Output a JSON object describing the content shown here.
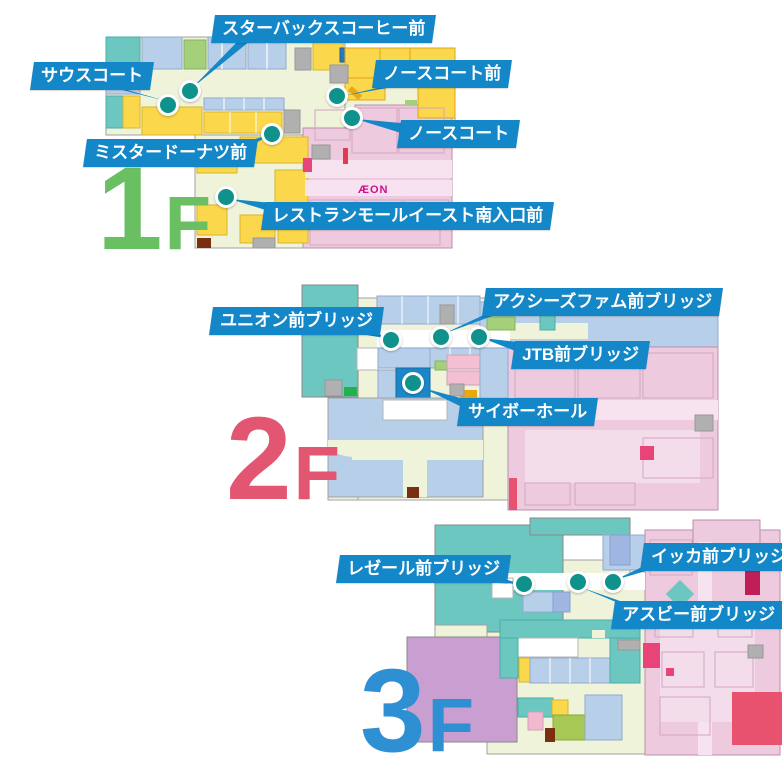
{
  "palette": {
    "callout_blue": "#1387c8",
    "marker_teal": "#0f918c",
    "floor1_green": "#6abf62",
    "floor2_pink": "#e25672",
    "floor3_blue": "#2e8fd3",
    "aeon_magenta": "#cc0e8f",
    "map_teal": "#6cc7c0",
    "map_lightblue": "#b7cfe8",
    "map_yellow": "#fad74b",
    "map_pink": "#eecade",
    "map_cream": "#eef3da"
  },
  "floors": [
    {
      "name": "1F",
      "number": "1",
      "suffix": "F",
      "aeon_logo": "ÆON",
      "callouts": [
        {
          "id": "starbucks-front",
          "text": "スターバックスコーヒー前"
        },
        {
          "id": "south-court",
          "text": "サウスコート"
        },
        {
          "id": "north-court-front",
          "text": "ノースコート前"
        },
        {
          "id": "north-court",
          "text": "ノースコート"
        },
        {
          "id": "mister-donut-front",
          "text": "ミスタードーナツ前"
        },
        {
          "id": "restaurant-mall-east-south-entrance-front",
          "text": "レストランモールイースト南入口前"
        }
      ]
    },
    {
      "name": "2F",
      "number": "2",
      "suffix": "F",
      "callouts": [
        {
          "id": "axes-femme-front-bridge",
          "text": "アクシーズファム前ブリッジ"
        },
        {
          "id": "union-front-bridge",
          "text": "ユニオン前ブリッジ"
        },
        {
          "id": "jtb-front-bridge",
          "text": "JTB前ブリッジ"
        },
        {
          "id": "saibo-hall",
          "text": "サイボーホール"
        }
      ]
    },
    {
      "name": "3F",
      "number": "3",
      "suffix": "F",
      "callouts": [
        {
          "id": "ikka-front-bridge",
          "text": "イッカ前ブリッジ"
        },
        {
          "id": "lezere-front-bridge",
          "text": "レゼール前ブリッジ"
        },
        {
          "id": "asbee-front-bridge",
          "text": "アスビー前ブリッジ"
        }
      ]
    }
  ]
}
